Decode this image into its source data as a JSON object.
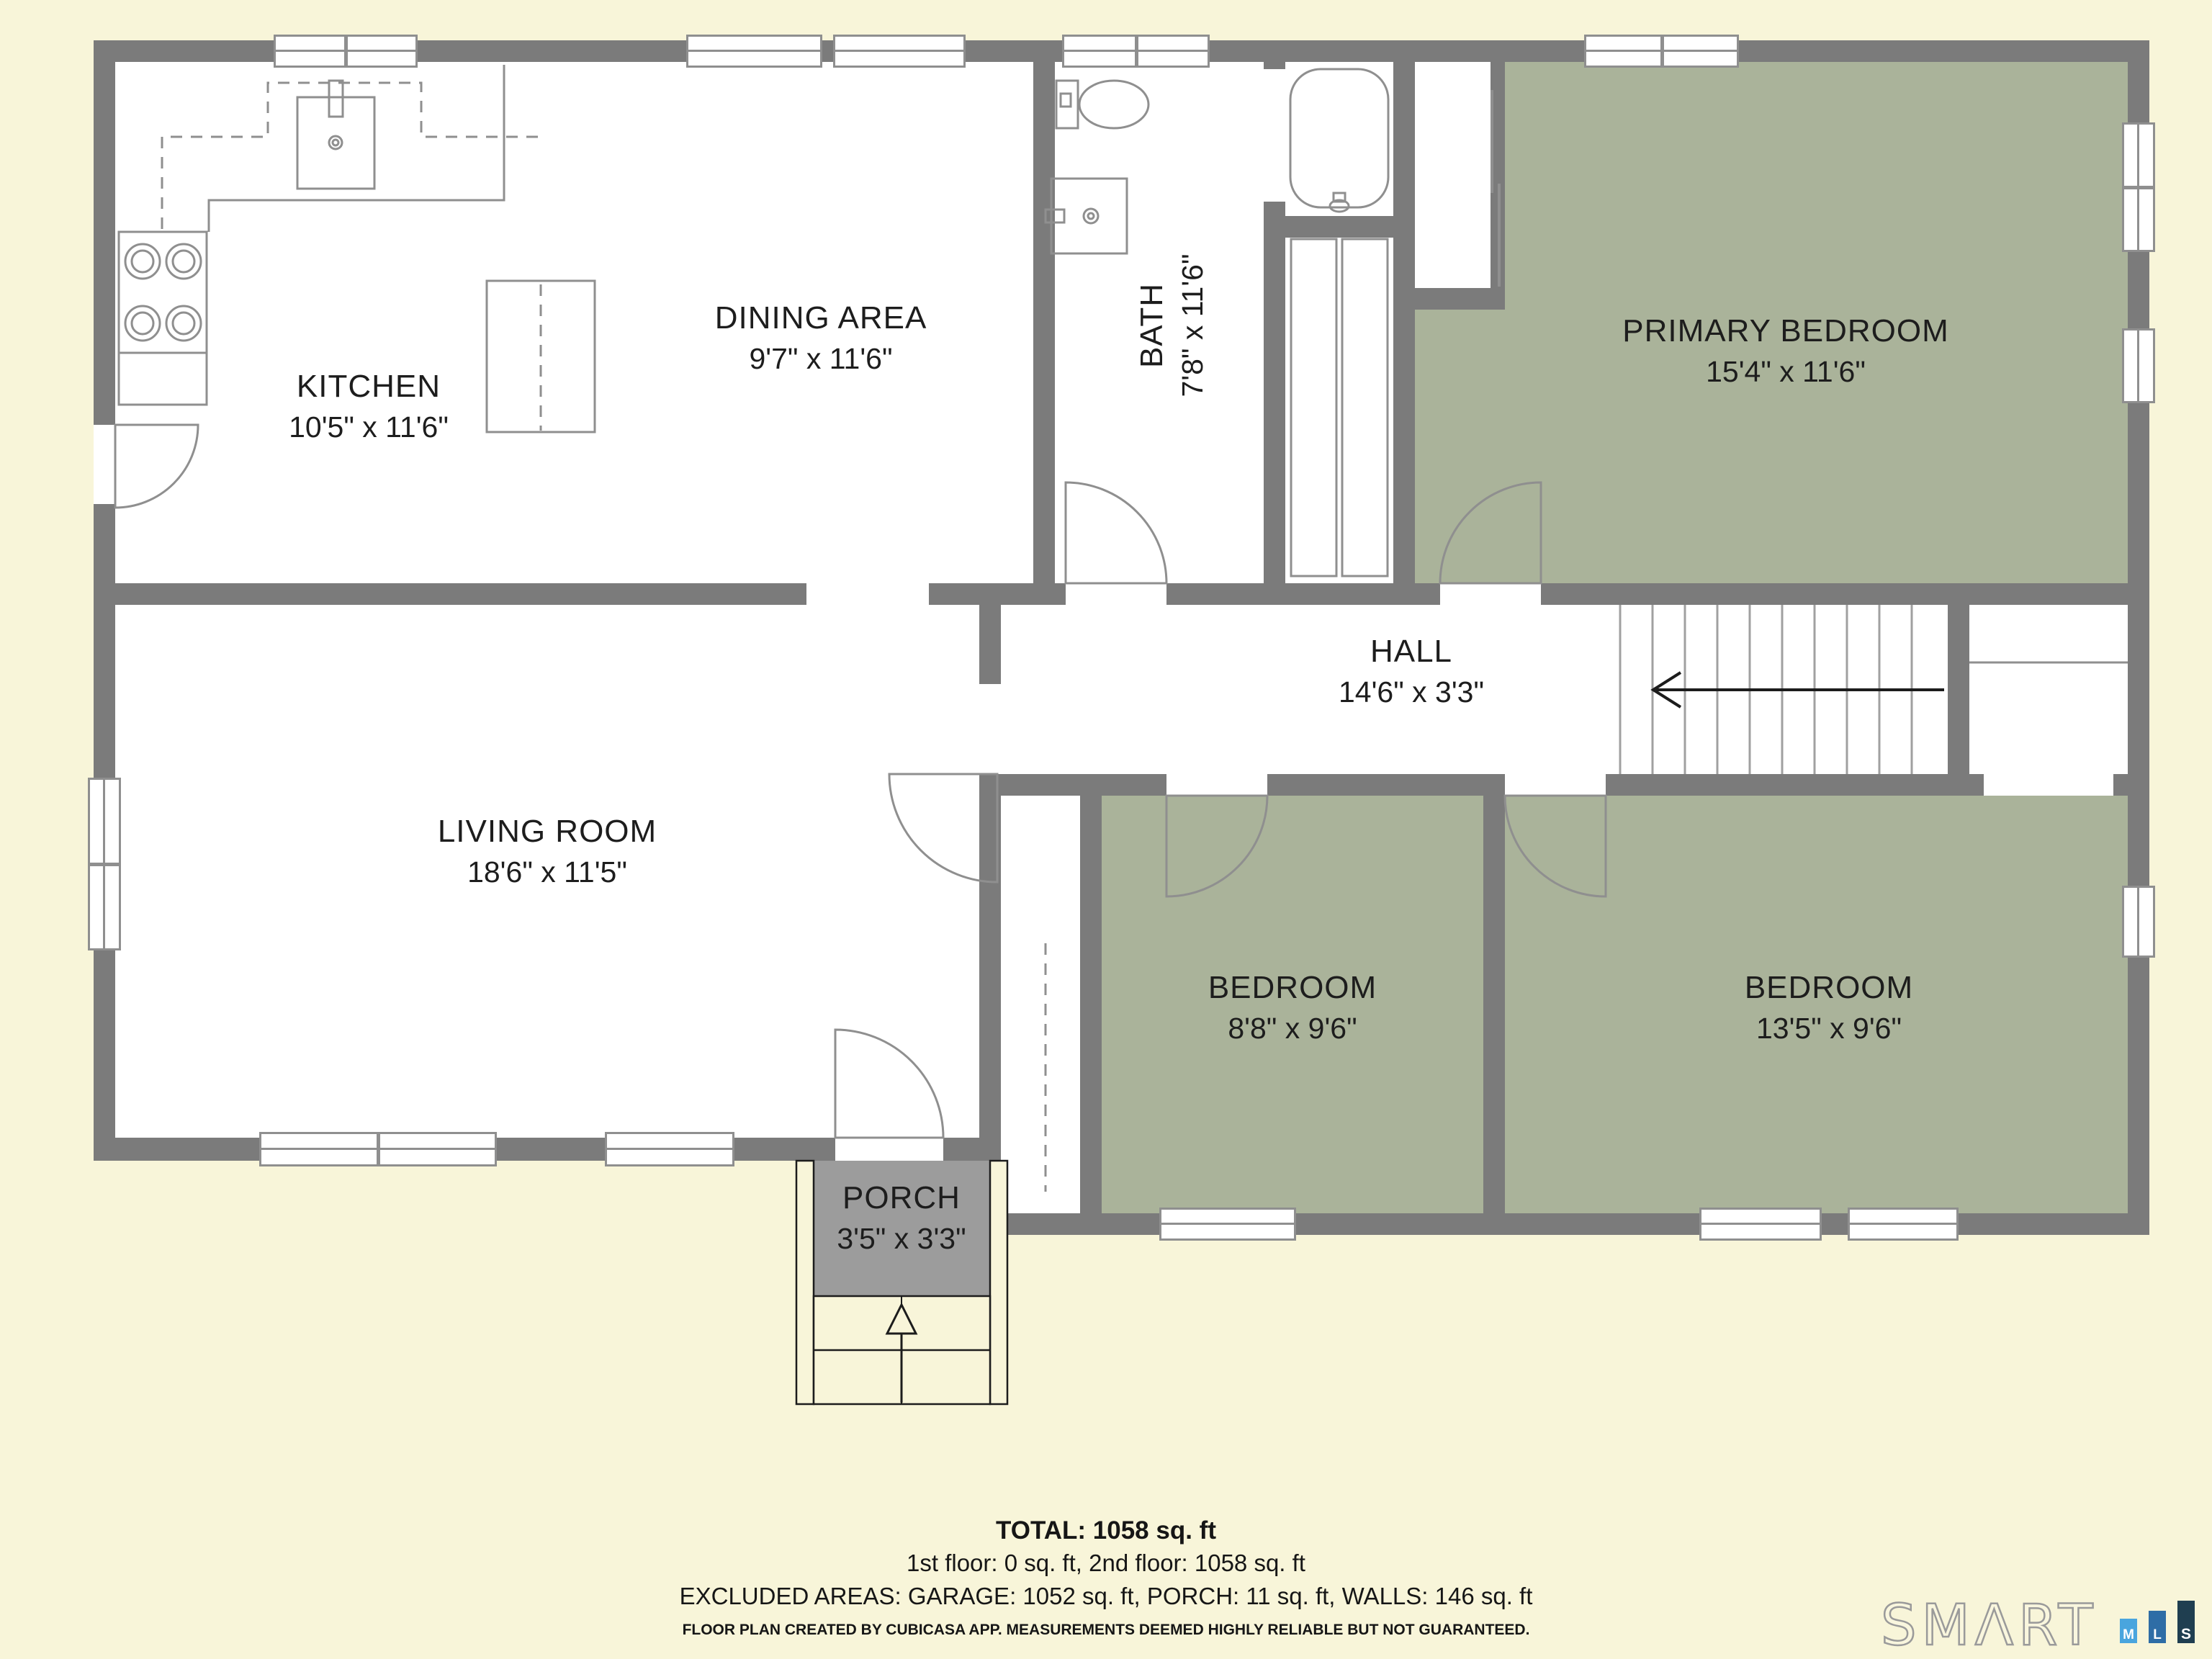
{
  "rooms": {
    "kitchen": {
      "name": "KITCHEN",
      "dims": "10'5\" x 11'6\""
    },
    "dining": {
      "name": "DINING AREA",
      "dims": "9'7\" x 11'6\""
    },
    "bath": {
      "name": "BATH",
      "dims": "7'8\" x 11'6\""
    },
    "primary": {
      "name": "PRIMARY BEDROOM",
      "dims": "15'4\" x 11'6\""
    },
    "hall": {
      "name": "HALL",
      "dims": "14'6\" x 3'3\""
    },
    "living": {
      "name": "LIVING ROOM",
      "dims": "18'6\" x 11'5\""
    },
    "bedroom1": {
      "name": "BEDROOM",
      "dims": "8'8\" x 9'6\""
    },
    "bedroom2": {
      "name": "BEDROOM",
      "dims": "13'5\" x 9'6\""
    },
    "porch": {
      "name": "PORCH",
      "dims": "3'5\" x 3'3\""
    }
  },
  "summary": {
    "total": "TOTAL: 1058 sq. ft",
    "floors": "1st floor: 0 sq. ft, 2nd floor: 1058 sq. ft",
    "excluded": "EXCLUDED AREAS: GARAGE: 1052 sq. ft, PORCH: 11 sq. ft, WALLS: 146 sq. ft",
    "disclaimer": "FLOOR PLAN CREATED BY CUBICASA APP. MEASUREMENTS DEEMED HIGHLY RELIABLE BUT NOT GUARANTEED."
  },
  "logo": {
    "brand": "SMΛRT",
    "bars": [
      {
        "letter": "M",
        "color": "#49a5de"
      },
      {
        "letter": "L",
        "color": "#2e6da6"
      },
      {
        "letter": "S",
        "color": "#1f3e50"
      }
    ]
  },
  "colors": {
    "background": "#f8f5d9",
    "wall": "#7b7b7b",
    "room_fill": "#ffffff",
    "bedroom_fill": "#aab39a",
    "porch_fill": "#9c9c9c",
    "fixture_line": "#8f8f8f",
    "text": "#1d1d1d"
  }
}
